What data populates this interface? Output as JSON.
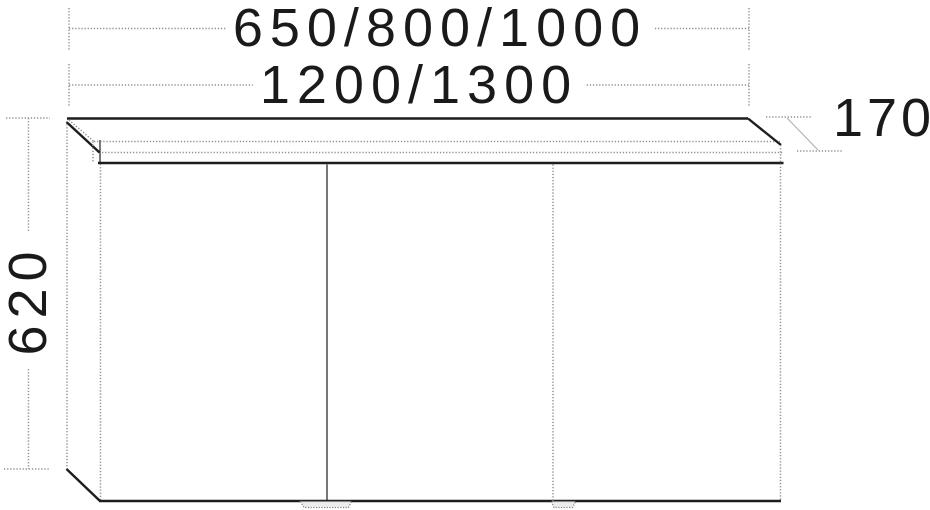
{
  "drawing": {
    "dimension_labels": {
      "width_options_row1": "650/800/1000",
      "width_options_row2": "1200/1300",
      "height": "620",
      "depth": "170"
    },
    "colors": {
      "solid_line": "#1d1d1d",
      "dotted_hidden_line": "#929292",
      "background": "#ffffff"
    }
  }
}
